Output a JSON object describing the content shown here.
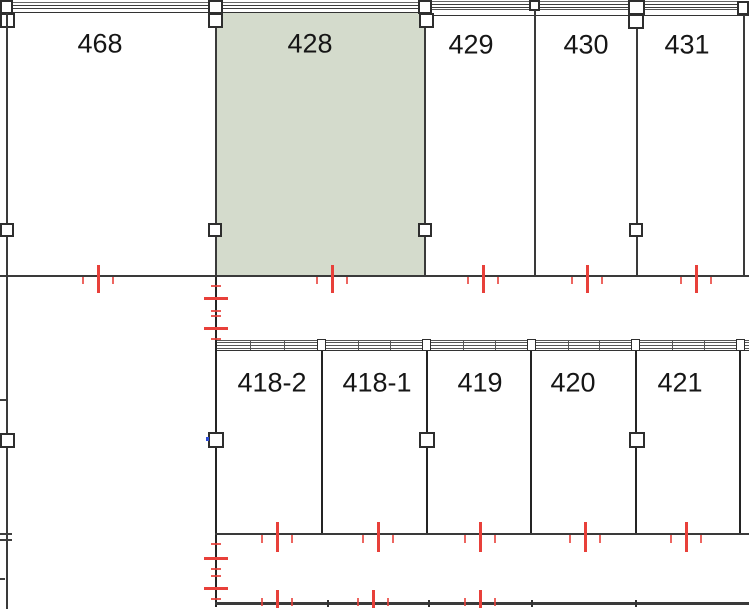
{
  "plan": {
    "type": "building-floor-plan",
    "rooms_top": [
      {
        "label": "468",
        "highlighted": false
      },
      {
        "label": "428",
        "highlighted": true
      },
      {
        "label": "429",
        "highlighted": false
      },
      {
        "label": "430",
        "highlighted": false
      },
      {
        "label": "431",
        "highlighted": false
      }
    ],
    "rooms_bottom": [
      {
        "label": "418-2",
        "highlighted": false
      },
      {
        "label": "418-1",
        "highlighted": false
      },
      {
        "label": "419",
        "highlighted": false
      },
      {
        "label": "420",
        "highlighted": false
      },
      {
        "label": "421",
        "highlighted": false
      }
    ],
    "colors": {
      "highlight_fill": "#d4dbcc",
      "tick_red": "#e8403a",
      "wall_gray": "#3a3a3a",
      "blue_mark": "#2b4bd7"
    }
  }
}
